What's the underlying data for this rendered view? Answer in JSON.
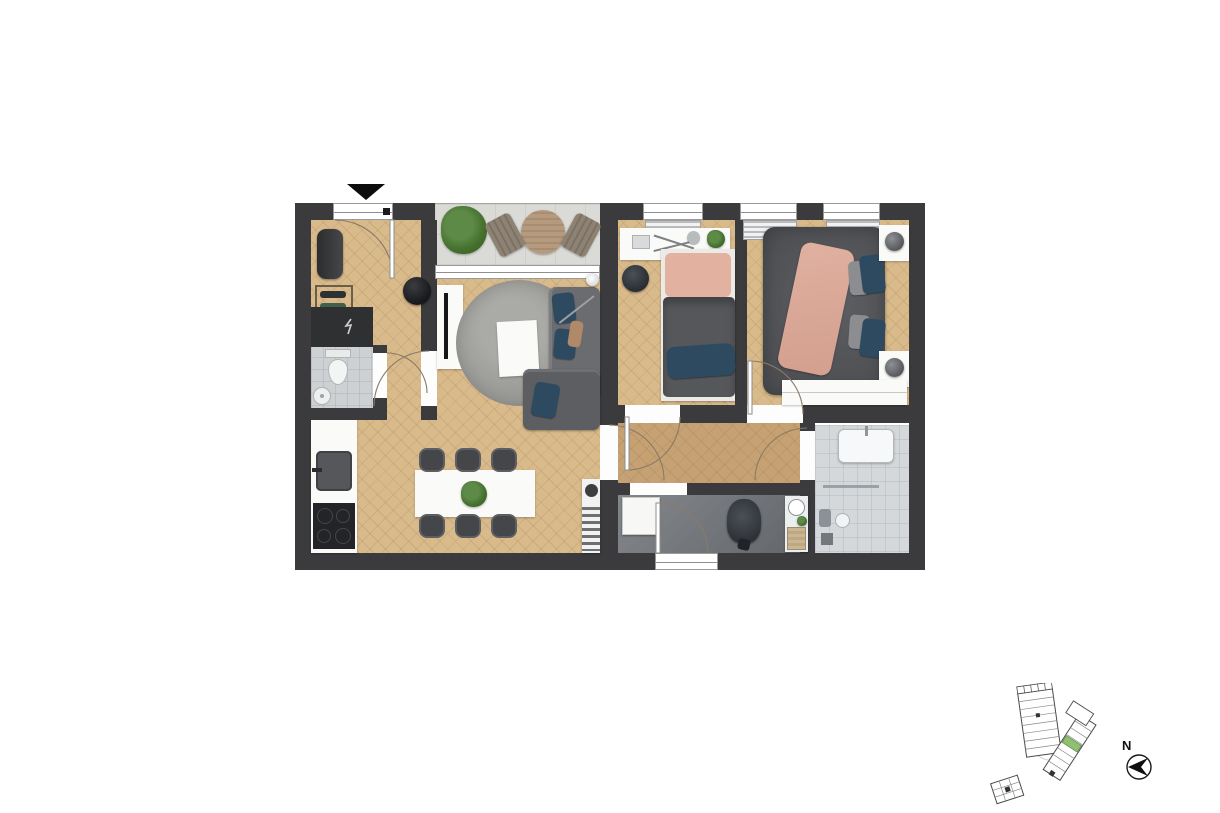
{
  "compass": {
    "label": "N"
  },
  "palette": {
    "wall": "#3b3b3d",
    "wood_floor": "#d9ba8b",
    "corridor_wood": "#c6a173",
    "balcony_tile": "#dadbd7",
    "wc_tile": "#cdd1d3",
    "shower_tile": "#d4d8da",
    "laundry_floor": "#6e7276",
    "rug_gray": "#9f9f9b",
    "sofa_gray": "#6a6c70",
    "accent_navy": "#2e4a60",
    "accent_blush": "#dfae9e",
    "bed_gray": "#55565a",
    "plant_green": "#46712f",
    "site_unit_highlight": "#8fbf6f"
  },
  "floor_plan": {
    "type": "apartment-top-view-render",
    "entrance_marker": "black-triangle-arrow",
    "rooms": [
      {
        "name": "entrance-hall",
        "floor": "wood",
        "furniture": [
          "bench",
          "shoe-rack",
          "pouf",
          "electrical-cabinet"
        ]
      },
      {
        "name": "wc",
        "floor": "tile",
        "furniture": [
          "toilet",
          "round-washbasin"
        ]
      },
      {
        "name": "balcony",
        "floor": "tile",
        "furniture": [
          "plant",
          "round-table",
          "two-chairs"
        ]
      },
      {
        "name": "living-room",
        "floor": "wood",
        "furniture": [
          "tv-sideboard",
          "tv",
          "round-rug",
          "coffee-table",
          "corner-sofa",
          "floor-lamp"
        ]
      },
      {
        "name": "kitchen-dining",
        "floor": "wood",
        "furniture": [
          "kitchen-counter",
          "sink",
          "cooktop",
          "dining-table",
          "six-chairs",
          "plant-centerpiece",
          "side-console"
        ]
      },
      {
        "name": "small-bedroom",
        "floor": "wood",
        "furniture": [
          "desk",
          "laptop",
          "desk-lamp",
          "plant",
          "stool",
          "single-bed"
        ]
      },
      {
        "name": "master-bedroom",
        "floor": "wood",
        "furniture": [
          "double-bed",
          "two-nightstands",
          "two-lamps",
          "wardrobe"
        ]
      },
      {
        "name": "corridor",
        "floor": "wood",
        "furniture": []
      },
      {
        "name": "laundry-storage",
        "floor": "screed",
        "furniture": [
          "cabinet",
          "vacuum-cleaner",
          "shelf-with-basin",
          "basket"
        ]
      },
      {
        "name": "shower-room",
        "floor": "tile",
        "furniture": [
          "washbasin",
          "towel-rail",
          "shower-fitting",
          "floor-drain"
        ]
      }
    ],
    "openings": [
      "entrance-door",
      "balcony-sliding-window",
      "3-bedroom-windows",
      "laundry-exterior-door",
      "7-interior-doors"
    ]
  },
  "site_plan": {
    "buildings": 3,
    "highlighted_unit_color": "#8fbf6f",
    "style": "outline-key-plan"
  }
}
